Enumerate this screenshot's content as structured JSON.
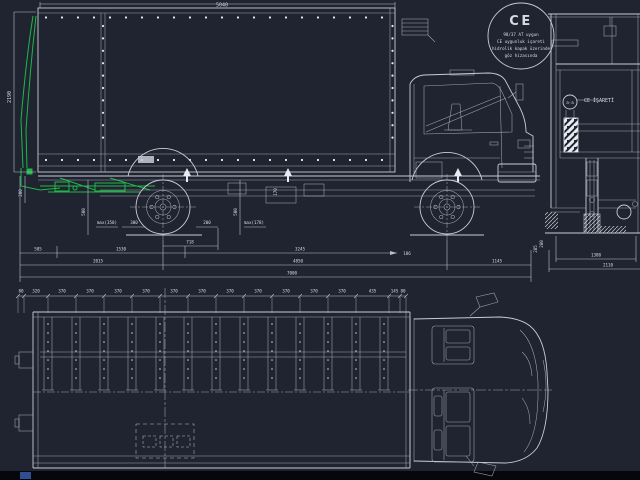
{
  "colors": {
    "background": "#1f2430",
    "line": "#c7ccd4",
    "green_accent": "#1fb848",
    "text": "#d6dbe2",
    "bottom_band": "#05070a",
    "model_tab_blue": "#2f4f94"
  },
  "badge": {
    "mark": "CE",
    "line1": "98/37 AT uygun",
    "line2": "CE uygunluk işareti",
    "line3": "hidrolik kapak üzerinde",
    "line4": "göz hizasında"
  },
  "rear_view": {
    "section_label": "a-a",
    "ce_label": "CE İŞARETİ",
    "dim_inner_width": "1380",
    "dim_overall_width": "2110",
    "dim_platform_height": "280"
  },
  "side_view": {
    "dim_box_length": "5040",
    "dim_box_height": "2190",
    "dim_rear_drop": "200",
    "dim_lift_rear": "500",
    "note_rear": "max(350)",
    "dim_rear_wheel_gap": "300",
    "dim_front_wheel_gap": "200",
    "dim_lift_front": "500",
    "note_front": "max(178)",
    "dim_axle_detail": "718",
    "dim_frame_height": "170",
    "dim_cab_gap": "186",
    "dim_right_height": "285",
    "rows": {
      "r1": [
        "505",
        "1530",
        "3245"
      ],
      "r2": [
        "2015",
        "4850",
        "1145"
      ],
      "r3": [
        "7000"
      ]
    }
  },
  "top_view": {
    "chain": [
      "80",
      "320",
      "370",
      "370",
      "370",
      "370",
      "370",
      "370",
      "370",
      "370",
      "370",
      "370",
      "370",
      "435",
      "145",
      "80"
    ]
  }
}
